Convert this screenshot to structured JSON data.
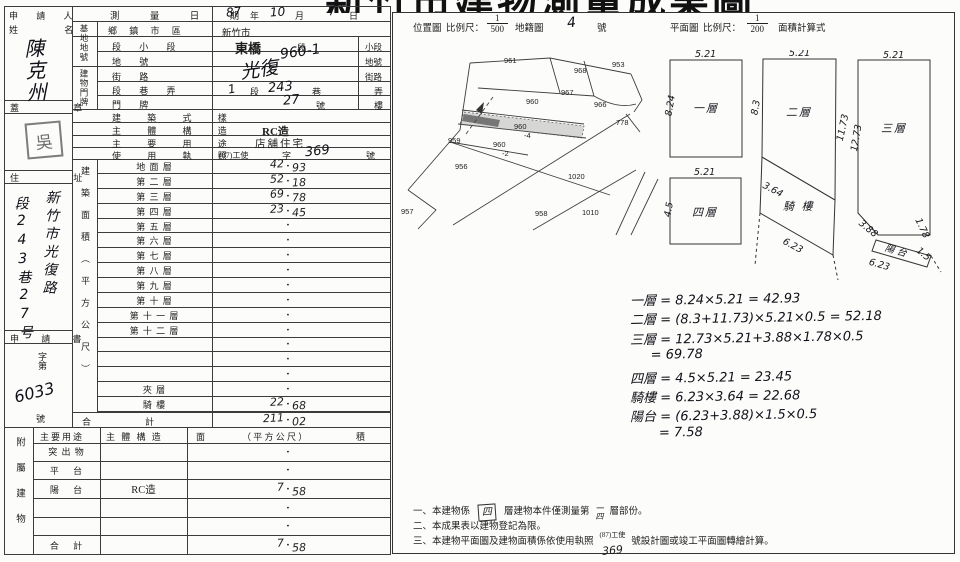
{
  "title": "新竹市建物測量成果圖",
  "form": {
    "applicant": {
      "label_line1": "申 請 人",
      "label_line2": "姓    名",
      "name": "陳克州"
    },
    "seal": {
      "label": "蓋    章",
      "stamp": "吳"
    },
    "survey_date": {
      "label": "測  量  日  期",
      "year": "87",
      "year_unit": "年",
      "month": "10",
      "month_unit": "月",
      "day": "7",
      "day_unit": "日"
    },
    "site": {
      "group": "基地地號",
      "district_label": "鄉 鎮 市 區",
      "district": "新竹市",
      "section_label": "段  小  段",
      "section": "東橋",
      "section_unit": "段",
      "subsection_unit": "小段",
      "parcel": "960-1",
      "parcel_label": "地      號",
      "parcel_unit": "地號"
    },
    "door": {
      "group": "建物門牌",
      "street_label": "街      路",
      "street": "光復",
      "street_unit": "街路",
      "lane_label": "段  巷  弄",
      "seg_no": "1",
      "seg_unit": "段",
      "lane_no": "243",
      "lane_unit": "巷",
      "alley_unit": "弄",
      "no_label": "門      牌",
      "door_no": "27",
      "no_unit": "號",
      "floor_unit": "樓"
    },
    "style": {
      "label": "建  築  式  樣",
      "value": ""
    },
    "structure": {
      "label": "主  體  構  造",
      "value": "RC造"
    },
    "use": {
      "label": "主  要  用  途",
      "value": "店舖住宅"
    },
    "license": {
      "label": "使  用  執  照",
      "prefix": "(87)工使",
      "zi": "字",
      "number": "369",
      "unit": "號"
    },
    "address": {
      "label": "住    址",
      "col1": "新竹市光復路",
      "col2": "段243巷27号"
    },
    "application": {
      "label": "申 請 書",
      "zidai": "字第",
      "number": "6033",
      "unit": "號"
    },
    "area": {
      "group": "建築面積（平方公尺）",
      "dot": "·",
      "rows": [
        {
          "label": "地 面 層",
          "int": "42",
          "dec": "93"
        },
        {
          "label": "第 二 層",
          "int": "52",
          "dec": "18"
        },
        {
          "label": "第 三 層",
          "int": "69",
          "dec": "78"
        },
        {
          "label": "第 四 層",
          "int": "23",
          "dec": "45"
        },
        {
          "label": "第 五 層",
          "int": "",
          "dec": ""
        },
        {
          "label": "第 六 層",
          "int": "",
          "dec": ""
        },
        {
          "label": "第 七 層",
          "int": "",
          "dec": ""
        },
        {
          "label": "第 八 層",
          "int": "",
          "dec": ""
        },
        {
          "label": "第 九 層",
          "int": "",
          "dec": ""
        },
        {
          "label": "第 十 層",
          "int": "",
          "dec": ""
        },
        {
          "label": "第 十 一 層",
          "int": "",
          "dec": ""
        },
        {
          "label": "第 十 二 層",
          "int": "",
          "dec": ""
        },
        {
          "label": "",
          "int": "",
          "dec": ""
        },
        {
          "label": "",
          "int": "",
          "dec": ""
        },
        {
          "label": "",
          "int": "",
          "dec": ""
        },
        {
          "label": "夾      層",
          "int": "",
          "dec": ""
        },
        {
          "label": "騎      樓",
          "int": "22",
          "dec": "68"
        }
      ],
      "total": {
        "label": "合",
        "label2": "計",
        "int": "211",
        "dec": "02"
      }
    },
    "attached": {
      "group": "附屬建物",
      "header": {
        "use": "主要用途",
        "structure": "主 體 構 造",
        "area_left": "面",
        "area_mid": "（ 平 方 公 尺 ）",
        "area_right": "積"
      },
      "rows": [
        {
          "label": "突 出 物",
          "structure": "",
          "int": "",
          "dec": ""
        },
        {
          "label": "平　 台",
          "structure": "",
          "int": "",
          "dec": ""
        },
        {
          "label": "陽　 台",
          "structure": "RC造",
          "int": "7",
          "dec": "58"
        },
        {
          "label": "",
          "structure": "",
          "int": "",
          "dec": ""
        },
        {
          "label": "",
          "structure": "",
          "int": "",
          "dec": ""
        },
        {
          "label": "合　 計",
          "structure": "",
          "int": "7",
          "dec": "58"
        }
      ]
    }
  },
  "panel": {
    "header": {
      "location_map": "位置圖",
      "scale_label": "比例尺：",
      "scale1_num": "1",
      "scale1_den": "500",
      "cadastral": "地籍圖",
      "map_no": "4",
      "map_no_unit": "號",
      "floor_plan": "平面圖",
      "scale2_label": "比例尺：",
      "scale2_num": "1",
      "scale2_den": "200",
      "calc_label": "面積計算式"
    },
    "map": {
      "labels": [
        {
          "t": "961",
          "x": 106,
          "y": 4
        },
        {
          "t": "968",
          "x": 176,
          "y": 14
        },
        {
          "t": "953",
          "x": 214,
          "y": 8
        },
        {
          "t": "967",
          "x": 163,
          "y": 36
        },
        {
          "t": "960",
          "x": 128,
          "y": 45
        },
        {
          "t": "966",
          "x": 196,
          "y": 48
        },
        {
          "t": "960",
          "x": 116,
          "y": 70
        },
        {
          "t": "-4",
          "x": 126,
          "y": 79
        },
        {
          "t": "959",
          "x": 50,
          "y": 84
        },
        {
          "t": "960",
          "x": 95,
          "y": 88
        },
        {
          "t": "-2",
          "x": 104,
          "y": 97
        },
        {
          "t": "778",
          "x": 218,
          "y": 66
        },
        {
          "t": "956",
          "x": 57,
          "y": 110
        },
        {
          "t": "1020",
          "x": 170,
          "y": 120
        },
        {
          "t": "957",
          "x": 3,
          "y": 155
        },
        {
          "t": "958",
          "x": 137,
          "y": 157
        },
        {
          "t": "1010",
          "x": 184,
          "y": 156
        }
      ]
    },
    "plans": {
      "p1": {
        "name": "一層",
        "top": "5.21",
        "left": "8.24"
      },
      "p2": {
        "name": "二層",
        "top": "5.21",
        "left": "8.3",
        "right": "11.73"
      },
      "arcade": {
        "name": "騎 樓",
        "side": "3.64",
        "bottom": "6.23"
      },
      "p3": {
        "name": "三層",
        "top": "5.21",
        "left": "12.73",
        "cut": "3.88",
        "edge": "1.78",
        "balcony": "陽 台",
        "bwidth": "1.5",
        "bbottom": "6.23"
      },
      "p4": {
        "name": "四層",
        "top": "5.21",
        "left": "4.5"
      }
    },
    "calc": {
      "lines": [
        {
          "t": "一層 = 8.24×5.21 = 42.93"
        },
        {
          "t": "二層 = (8.3+11.73)×5.21×0.5 = 52.18"
        },
        {
          "t": "三層 = 12.73×5.21+3.88×1.78×0.5"
        },
        {
          "t": "     = 69.78"
        },
        {
          "t": "四層 = 4.5×5.21 = 23.45"
        },
        {
          "t": "騎樓 = 6.23×3.64 = 22.68"
        },
        {
          "t": "陽台 = (6.23+3.88)×1.5×0.5"
        },
        {
          "t": "       = 7.58"
        }
      ]
    },
    "notes": {
      "n1_num": "一、",
      "n1_pre": "本建物係",
      "n1_hw1": "四",
      "n1_mid": "層建物本件僅測量第",
      "n1_hw2_top": "一",
      "n1_hw2_bottom": "四",
      "n1_post": "層部份。",
      "n2": "二、本成果表以建物登記為限。",
      "n3_num": "三、",
      "n3_pre": "本建物平面圖及建物面積係依使用執照",
      "n3_sup": "(87)工使",
      "n3_hw": "369",
      "n3_post": "號設計圖或竣工平面圖轉繪計算。"
    }
  }
}
